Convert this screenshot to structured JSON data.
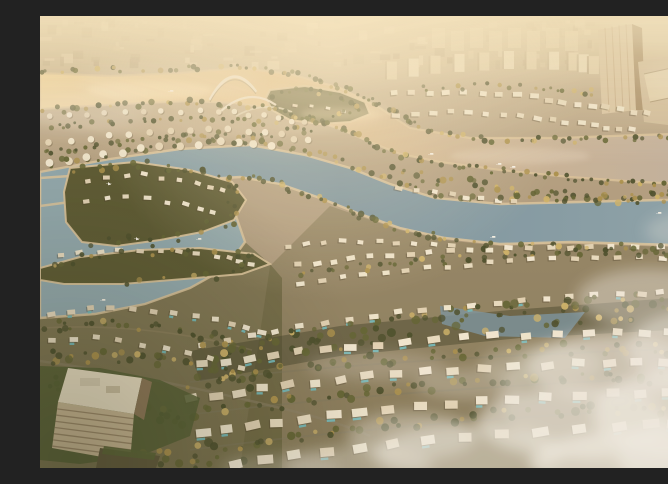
{
  "meta": {
    "description": "Aerial CGI rendering at golden hour of a master-planned waterfront villa community: curved concentric rows of white villas with private pools along palm-lined streets, a sunlit golden canal crossed by an arched pedestrian bridge, a winding blue lagoon with sandy beaches, a villa peninsula and island, small sailboats on the water, a hazy low-rise city skyline with a glass high-rise tower and angular mall complex at the top right, a low-rise hotel block in parkland at the bottom left, and soft mist drifting over the lower villa district."
  },
  "scene": {
    "time_of_day": "golden hour, hazy sunset light",
    "colors": {
      "sky_haze": "#cdbb9c",
      "bg_mid": "#b3a083",
      "bg_low": "#97876a",
      "city_base": "#c2b090",
      "city_light": "#dbc9a9",
      "city_dark": "#aa9678",
      "block_white": "#e7dabd",
      "gold_water_bright": "#f0d6a2",
      "gold_water": "#e0bf8c",
      "gold_water_grey": "#c0b0a0",
      "teal_water": "#7792a0",
      "teal_water_light": "#8ea8b0",
      "sand": "#dcc49c",
      "palm_dark": "#454a28",
      "palm_mid": "#5d6030",
      "palm_gold": "#a98f4a",
      "palm_bright": "#cdb268",
      "villa_tone_a": "#f2e9d4",
      "villa_tone_b": "#e9ddc3",
      "villa_tone_c": "#e2d3b6",
      "villa_tone_d": "#efe6cf",
      "villa_shadow": "#443a26",
      "pool": "#6fb9bd",
      "park_green": "#56552f",
      "park_dark": "#41422a",
      "hotel_face": "#c9b795",
      "hotel_stripe": "#8a765a",
      "hotel_roof": "#ece1c8",
      "hotel_side": "#8a7456",
      "tower_face": "#d8c5a4",
      "tower_side": "#a38a66",
      "mall_roof": "#cfbc9c",
      "mall_facet": "#e2d1b0",
      "bridge": "#efe6d2",
      "boat_white": "#f7f3ea",
      "mist": "#f0ede6",
      "glint": "#ffe9bb"
    },
    "landmarks": [
      {
        "name": "city-skyline",
        "label": "Hazy low-rise city blocks along the horizon"
      },
      {
        "name": "glass-tower",
        "label": "High-rise glass tower at top right"
      },
      {
        "name": "mall-complex",
        "label": "Angular large-roof complex beside the tower"
      },
      {
        "name": "golden-canal",
        "label": "Sunlit golden canal below the skyline"
      },
      {
        "name": "arch-bridge",
        "label": "Arched pedestrian bridge over the golden canal"
      },
      {
        "name": "villa-rows",
        "label": "Curved concentric rows of white villas with pools"
      },
      {
        "name": "lagoon",
        "label": "Winding blue lagoon and canals with sandy beaches"
      },
      {
        "name": "peninsula",
        "label": "Villa peninsula and island inside the lagoon"
      },
      {
        "name": "boats",
        "label": "Small sailboats and boats on the water"
      },
      {
        "name": "hotel-building",
        "label": "Low-rise hotel block in parkland at bottom left"
      },
      {
        "name": "mist-clouds",
        "label": "Soft mist drifting over the lower villa district"
      },
      {
        "name": "palm-trees",
        "label": "Dense palm-lined streets and green belts"
      }
    ]
  }
}
